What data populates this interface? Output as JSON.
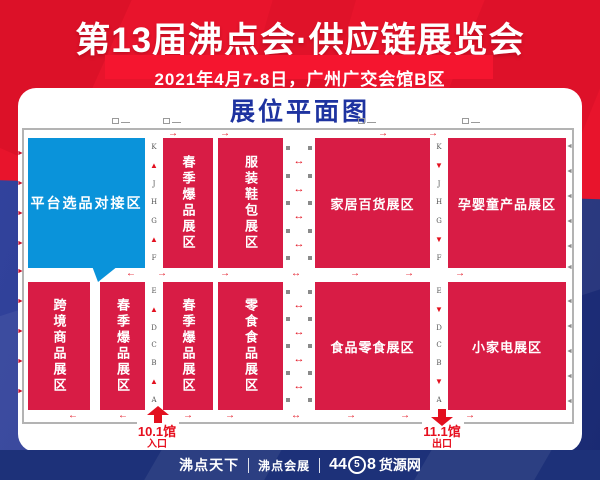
{
  "banner": {
    "title": "第13届沸点会·供应链展览会",
    "subtitle": "2021年4月7-8日，广州广交会馆B区"
  },
  "plan": {
    "title": "展位平面图",
    "zones": {
      "platform": {
        "label": "平台选品对接区"
      },
      "spring_top": {
        "label": "春季爆品展区"
      },
      "apparel": {
        "label": "服装鞋包展区"
      },
      "household": {
        "label": "家居百货展区"
      },
      "maternity": {
        "label": "孕婴童产品展区"
      },
      "crossborder": {
        "label": "跨境商品展区"
      },
      "spring_bl": {
        "label": "春季爆品展区"
      },
      "spring_br": {
        "label": "春季爆品展区"
      },
      "snack_food": {
        "label": "零食食品展区"
      },
      "food_snack": {
        "label": "食品零食展区"
      },
      "appliance": {
        "label": "小家电展区"
      }
    },
    "aisles": {
      "top": [
        "K",
        "J",
        "H",
        "G",
        "F"
      ],
      "bottom": [
        "E",
        "D",
        "C",
        "B",
        "A"
      ]
    },
    "entrance": {
      "hall": "10.1馆",
      "door": "入口"
    },
    "exit": {
      "hall": "11.1馆",
      "door": "出口"
    }
  },
  "icons": {
    "up": "▲",
    "down": "▼",
    "right": "→",
    "left": "←",
    "both": "↔"
  },
  "footer": {
    "logo_tianxia": "沸点天下",
    "logo_huizhan": "沸点会展",
    "logo_44": "44",
    "logo_5": "5",
    "logo_8": "8",
    "logo_huoyuan": "货源网"
  },
  "colors": {
    "banner_red": "#e8142c",
    "zone_crimson": "#d81c45",
    "zone_azure": "#0a93da",
    "navy": "#1d3179",
    "title_blue": "#1e33a0",
    "arrow_red": "#e3101f"
  }
}
